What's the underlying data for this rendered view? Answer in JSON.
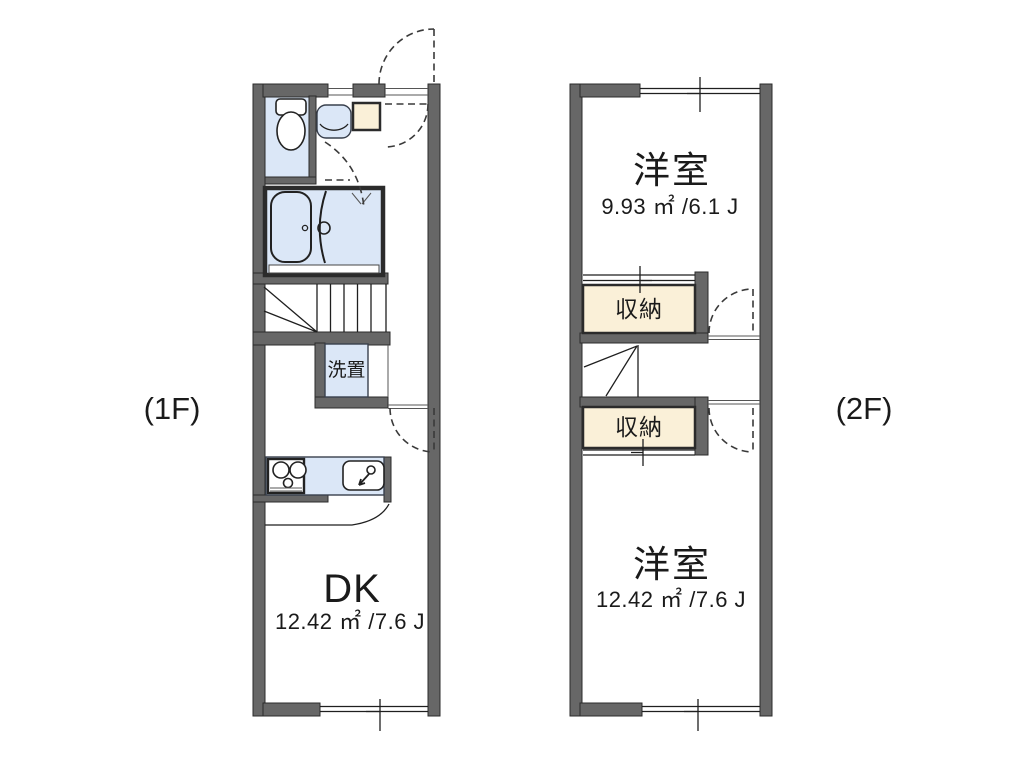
{
  "colors": {
    "wall": "#676767",
    "fixture": "#dbe7f7",
    "storage": "#faf0d8",
    "line": "#1f1f1f"
  },
  "floor1": {
    "label": "(1F)",
    "rooms": {
      "dk": {
        "name": "DK",
        "area": "12.42 ㎡ /7.6 J"
      },
      "washer": {
        "name": "洗置"
      }
    }
  },
  "floor2": {
    "label": "(2F)",
    "rooms": {
      "top": {
        "name": "洋室",
        "area": "9.93 ㎡ /6.1 J"
      },
      "bottom": {
        "name": "洋室",
        "area": "12.42 ㎡ /7.6 J"
      },
      "storage_top": {
        "name": "収納"
      },
      "storage_bottom": {
        "name": "収納"
      }
    }
  }
}
